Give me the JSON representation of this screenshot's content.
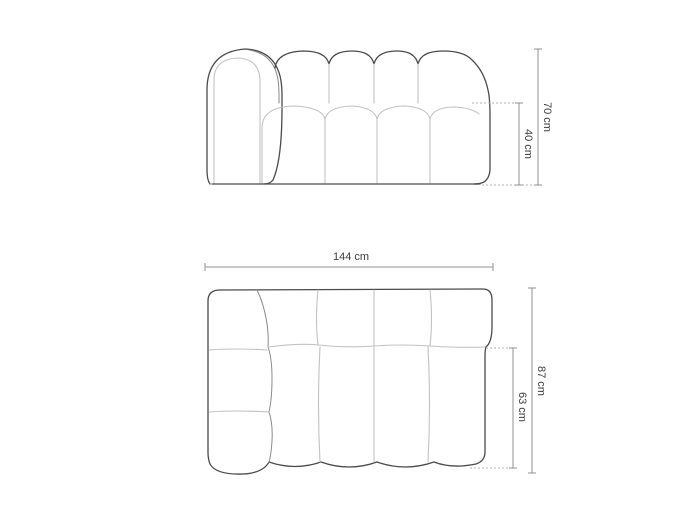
{
  "views": {
    "front_elevation": {
      "total_height": "70 cm",
      "seat_height": "40 cm"
    },
    "top_plan": {
      "total_width": "144 cm",
      "total_depth": "87 cm",
      "seat_depth": "63 cm"
    }
  },
  "colors": {
    "background": "#ffffff",
    "outline_dark": "#4a4a4a",
    "outline_mid": "#8a8a8a",
    "outline_light": "#c2c2c2",
    "dimension": "#909090",
    "dotted": "#b3b3b3",
    "text": "#3d3d3d"
  }
}
